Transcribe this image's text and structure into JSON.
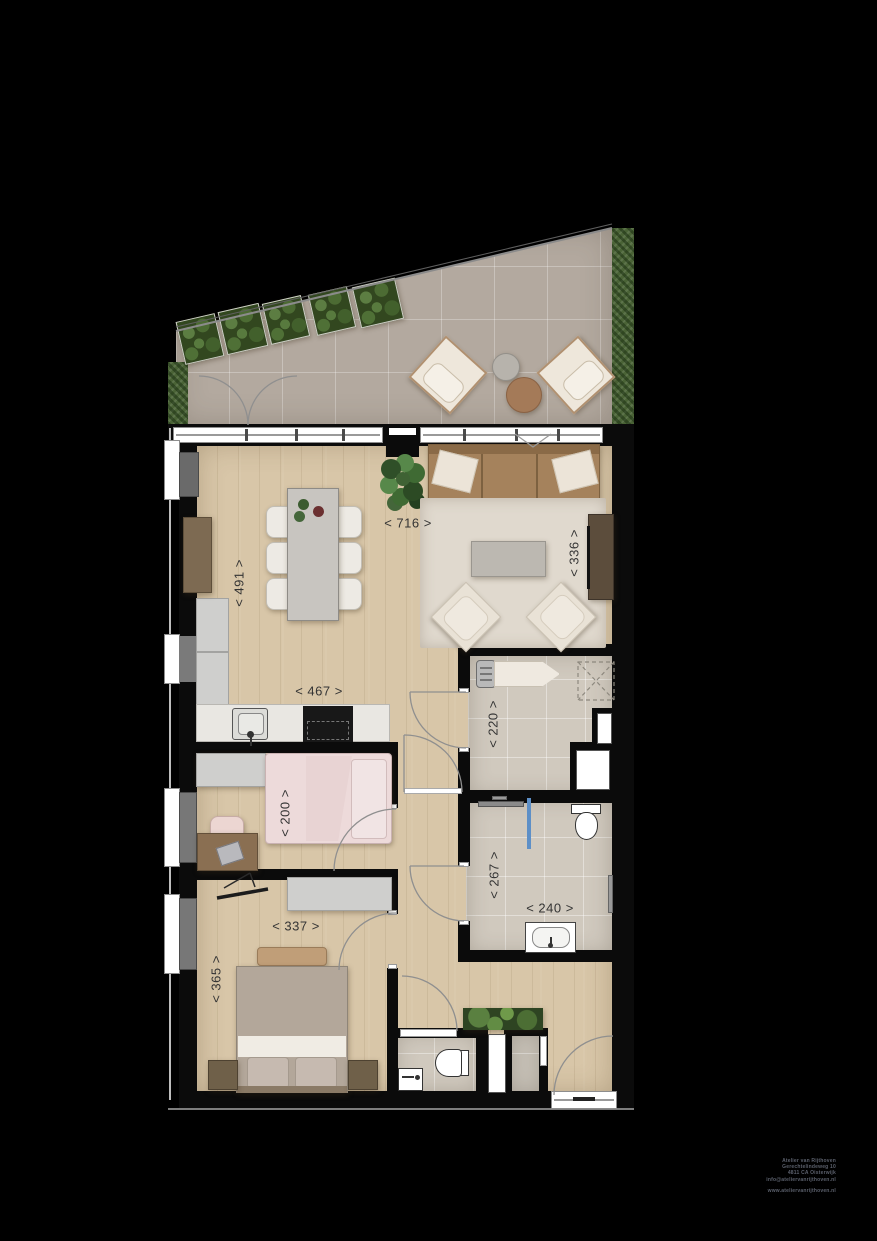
{
  "plan": {
    "type": "apartment-floor-plan-with-roof-terrace"
  },
  "dimensions": {
    "living_width": "< 716 >",
    "living_depth": "< 491 >",
    "lounge_width": "< 336 >",
    "kitchen_width": "< 467 >",
    "laundry_width": "< 220 >",
    "bedroom1_width": "< 200 >",
    "bathroom_depth": "< 267 >",
    "bathroom_width": "< 240 >",
    "bedroom2_width": "< 337 >",
    "bedroom2_depth": "< 365 >"
  },
  "footer": {
    "line1": "Atelier van Rijthoven",
    "line2": "Gerechtelindeweg 10",
    "line3": "4811 CA Oisterwijk",
    "line4": "info@ateliervanrijthoven.nl",
    "website": "www.ateliervanrijthoven.nl"
  },
  "colors": {
    "background": "#000000",
    "wood_floor": "#d8c6a8",
    "terrace_tile": "#b3a99f",
    "bath_tile": "#d0c9be",
    "hedge_green": "#4a6336",
    "shower_glass": "#5d8fc7",
    "dimension_text": "#343434"
  }
}
